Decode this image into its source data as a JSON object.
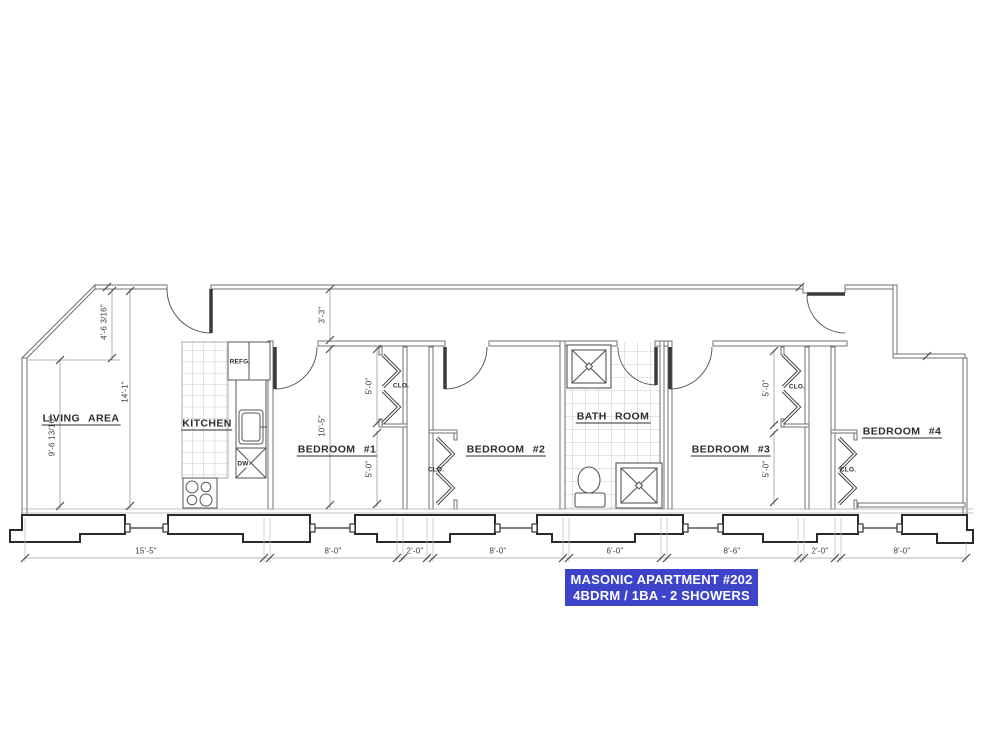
{
  "banner": {
    "title": "MASONIC APARTMENT #202",
    "subtitle": "4BDRM / 1BA - 2 SHOWERS",
    "bg_color": "#3e44c9",
    "text_color": "#ffffff"
  },
  "rooms": {
    "living_area": {
      "label": "LIVING AREA"
    },
    "kitchen": {
      "label": "KITCHEN"
    },
    "bedroom_1": {
      "label": "BEDROOM #1"
    },
    "bedroom_2": {
      "label": "BEDROOM #2"
    },
    "bath_room": {
      "label": "BATH ROOM"
    },
    "bedroom_3": {
      "label": "BEDROOM #3"
    },
    "bedroom_4": {
      "label": "BEDROOM #4"
    }
  },
  "fixtures": {
    "refrigerator": "REFG.",
    "dishwasher": "DW",
    "closet": "CLO."
  },
  "dimensions": {
    "diagonal_wall": "4'-6 3/16\"",
    "living_room_width": "9'-6 13/16\"",
    "living_room_depth": "14'-1\"",
    "hallway_width": "3'-3\"",
    "bedroom1_depth": "10'-5\"",
    "closet_width": "5'-0\"",
    "bottom_string": [
      "15'-5\"",
      "8'-0\"",
      "2'-0\"",
      "8'-0\"",
      "6'-0\"",
      "8'-6\"",
      "2'-0\"",
      "8'-0\""
    ]
  }
}
